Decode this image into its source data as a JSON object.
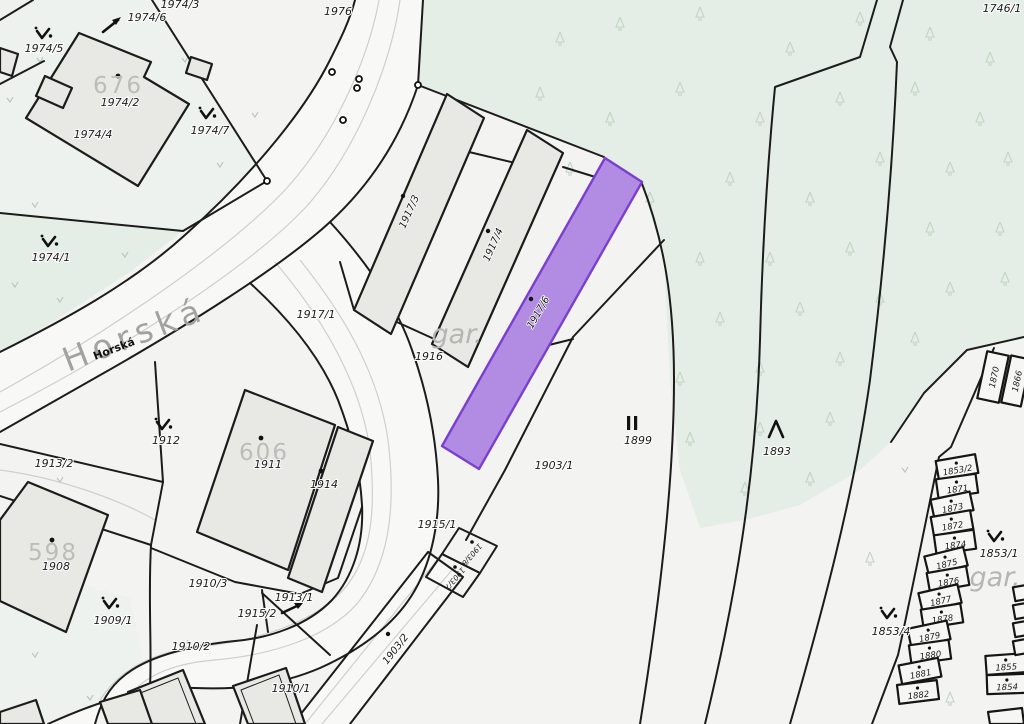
{
  "map_title": "Cadastral map",
  "highlighted_parcel": "1917/6",
  "street": {
    "name_large": "Horská",
    "name_small": "Horská"
  },
  "area_labels": {
    "gar_center": "gar.",
    "gar_right": "gar."
  },
  "building_numbers": {
    "b676": "676",
    "b606": "606",
    "b598": "598"
  },
  "parcel_labels": {
    "p1974_3": "1974/3",
    "p1974_6": "1974/6",
    "p1974_5": "1974/5",
    "p1974_2": "1974/2",
    "p1974_4": "1974/4",
    "p1974_7": "1974/7",
    "p1974_1": "1974/1",
    "p1976": "1976",
    "p1746_1": "1746/1",
    "p1917_1": "1917/1",
    "p1917_3": "1917/3",
    "p1917_4": "1917/4",
    "p1917_6": "1917/6",
    "p1916": "1916",
    "p1903_1": "1903/1",
    "p1899": "1899",
    "p1893": "1893",
    "p1912": "1912",
    "p1911": "1911",
    "p1914": "1914",
    "p1913_2": "1913/2",
    "p1908": "1908",
    "p1909_1": "1909/1",
    "p1910_3": "1910/3",
    "p1913_1": "1913/1",
    "p1915_2": "1915/2",
    "p1910_2": "1910/2",
    "p1910_1": "1910/1",
    "p1915_1": "1915/1",
    "p1903_2": "1903/2",
    "p1903_8": "1903/8",
    "p1903_7": "1903/7",
    "p1853_1": "1853/1",
    "p1853_4": "1853/4"
  },
  "garage_column": [
    "1853/2",
    "1871",
    "1873",
    "1872",
    "1874",
    "1875",
    "1876",
    "1877",
    "1878",
    "1879",
    "1880",
    "1881",
    "1882"
  ],
  "garage_pair_right": [
    "1855",
    "1854"
  ],
  "garage_pair_top": [
    "1870",
    "1866"
  ],
  "map_symbols": {
    "scrub_symbol": "∨.",
    "parallel_bars_symbol": "II",
    "tree_symbol": "Λ"
  },
  "colors": {
    "background": "#f3f3f1",
    "green": "#e4eee6",
    "green_pale": "#edf2ee",
    "road": "#f8f8f6",
    "building": "#e8e8e5",
    "boundary": "#1c1c1c",
    "highlight_fill": "#b28ce2",
    "highlight_stroke": "#7b3fd0",
    "muted_text": "#b5b5b2"
  }
}
